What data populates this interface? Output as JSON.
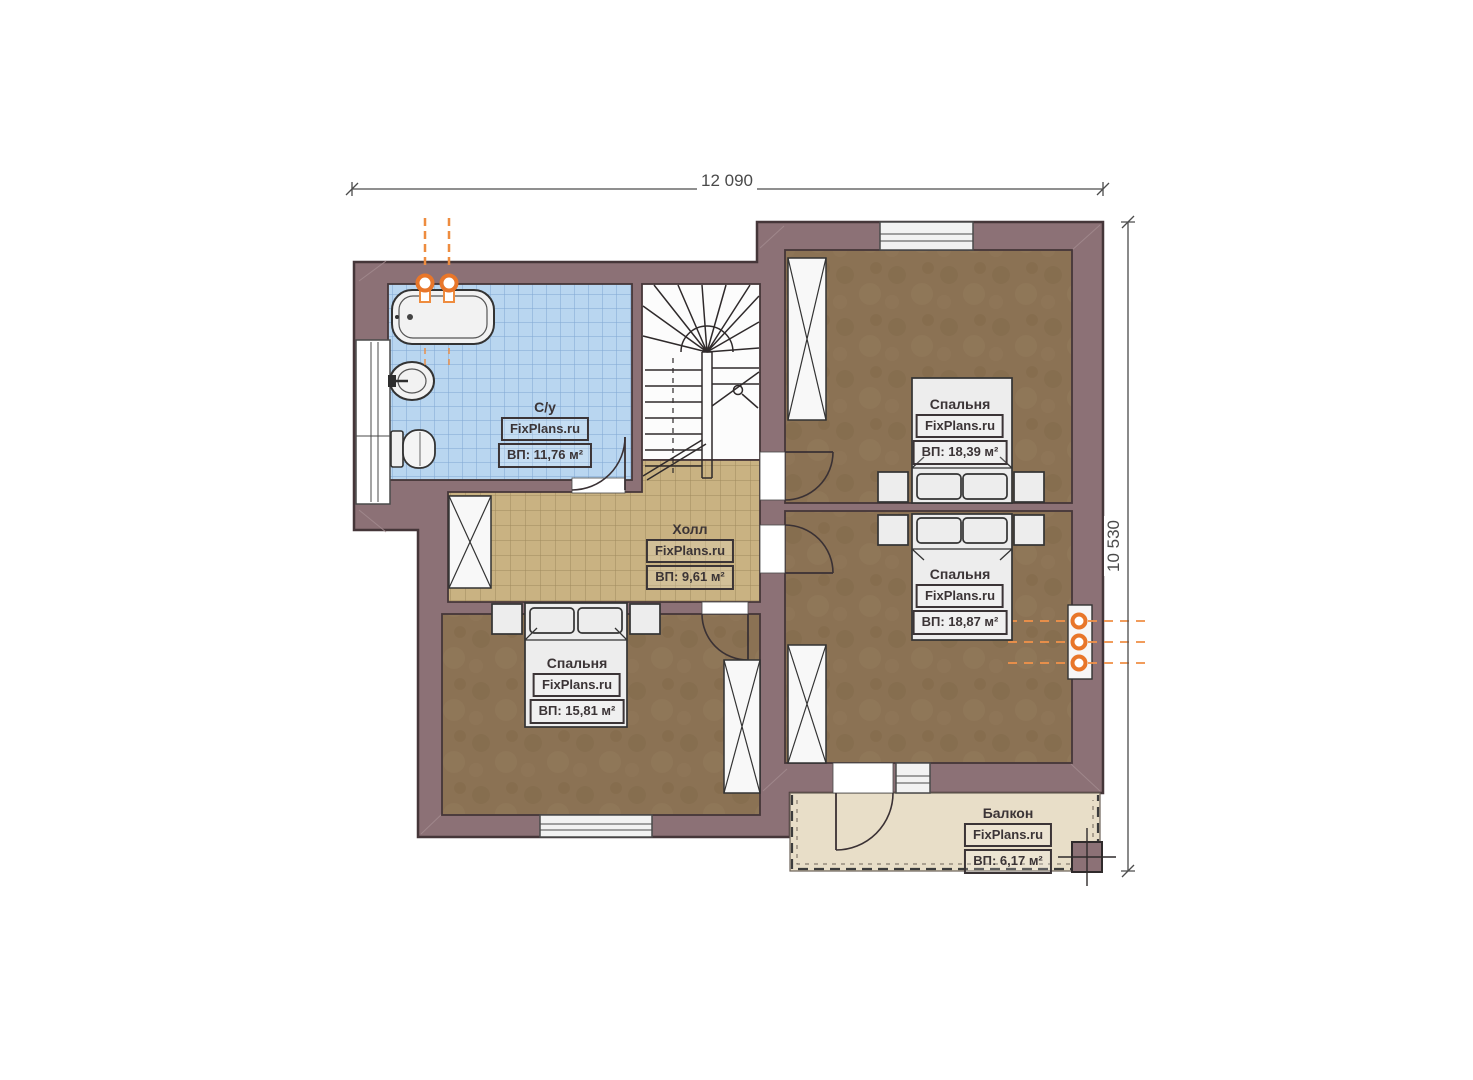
{
  "plan": {
    "watermark": "FixPlans.ru",
    "dimensions": {
      "width": "12 090",
      "height": "10 530"
    },
    "rooms": [
      {
        "id": "bathroom",
        "name": "С/у",
        "watermark": "FixPlans.ru",
        "area": "ВП: 11,76 м²"
      },
      {
        "id": "hall",
        "name": "Холл",
        "watermark": "FixPlans.ru",
        "area": "ВП: 9,61 м²"
      },
      {
        "id": "bedroom-top-right",
        "name": "Спальня",
        "watermark": "FixPlans.ru",
        "area": "ВП: 18,39 м²"
      },
      {
        "id": "bedroom-bottom-right",
        "name": "Спальня",
        "watermark": "FixPlans.ru",
        "area": "ВП: 18,87 м²"
      },
      {
        "id": "bedroom-left",
        "name": "Спальня",
        "watermark": "FixPlans.ru",
        "area": "ВП: 15,81 м²"
      },
      {
        "id": "balcony",
        "name": "Балкон",
        "watermark": "FixPlans.ru",
        "area": "ВП: 6,17 м²"
      }
    ],
    "colors": {
      "wall": "#8c7176",
      "wall_outline": "#453639",
      "wood_floor": "#8b7254",
      "hall_tile": "#c9b282",
      "bath_tile": "#b9d6f0",
      "balcony_floor": "#e8dec8",
      "accent_orange": "#ee8c3f"
    }
  }
}
